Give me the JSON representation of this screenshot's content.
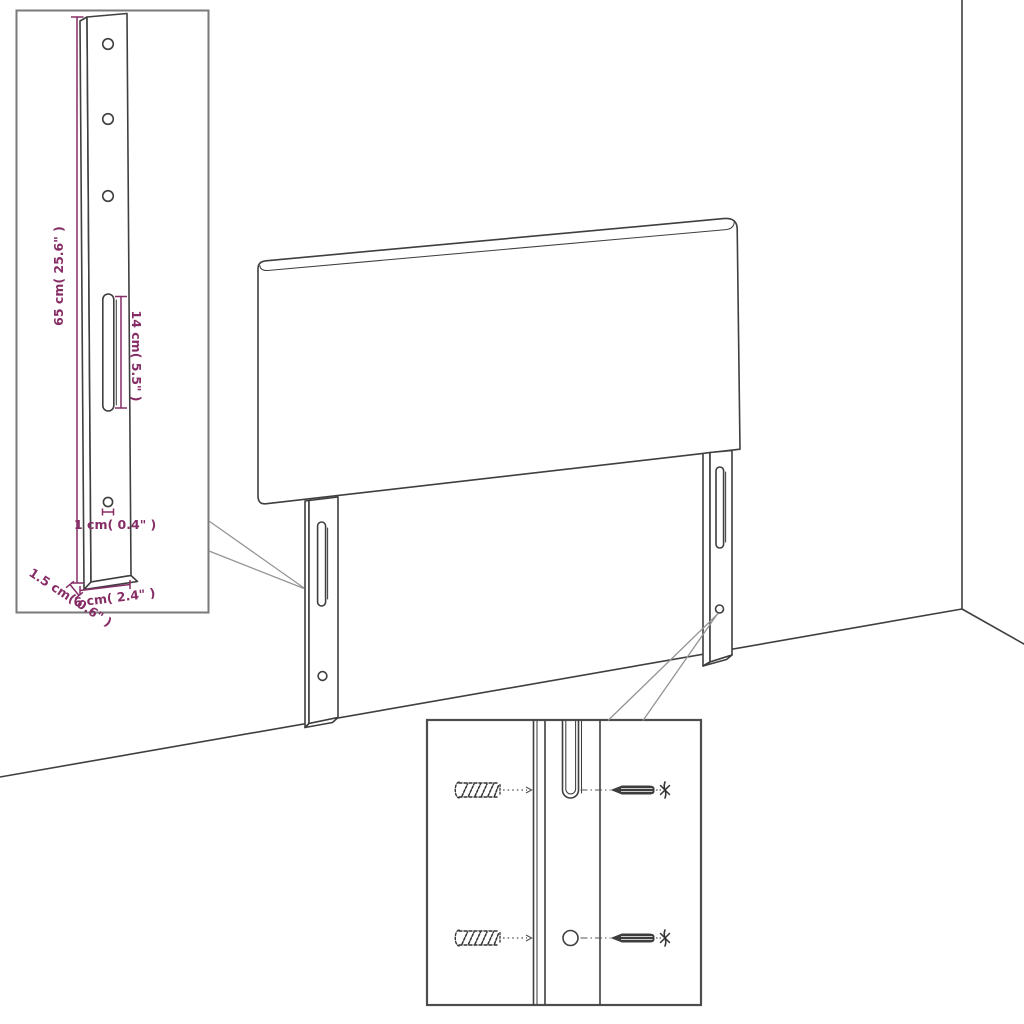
{
  "diagram": {
    "type": "product-dimension-diagram",
    "subject": "headboard with two mounting legs shown in a room corner",
    "colors": {
      "outline": "#3f3f3f",
      "dimension": "#862d66",
      "inset_border": "#7a7a7a",
      "leader": "#949494"
    },
    "bracket_inset": {
      "holes_count": 3,
      "dims": {
        "height": "65 cm( 25.6\" )",
        "slot_length": "14 cm( 5.5\" )",
        "hole": "1 cm( 0.4\" )",
        "thickness": "1.5 cm( 0.6\" )",
        "width": "6 cm( 2.4\" )"
      }
    },
    "hardware_inset": {
      "rows": 2,
      "items": [
        "wall-plug-icon",
        "screw-icon",
        "phillips-head-icon"
      ]
    }
  }
}
